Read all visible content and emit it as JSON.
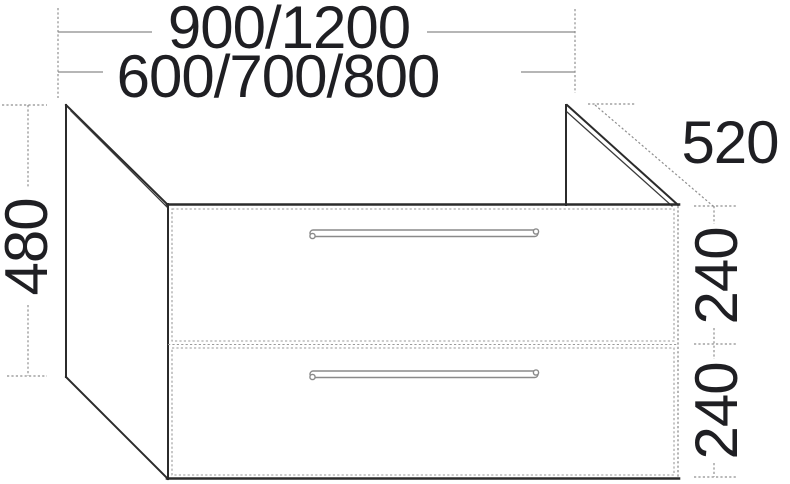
{
  "drawing": {
    "subject": "two-drawer washbasin vanity unit dimension drawing",
    "unit": "mm",
    "labels": {
      "width_options_top": "900/1200",
      "width_options_bottom": "600/700/800",
      "overall_height": "480",
      "depth": "520",
      "upper_drawer_height": "240",
      "lower_drawer_height": "240"
    },
    "colors": {
      "outline": "#2b2b2b",
      "dimension_line": "#8a8a8a",
      "text": "#1f1f23",
      "background": "#ffffff"
    }
  }
}
